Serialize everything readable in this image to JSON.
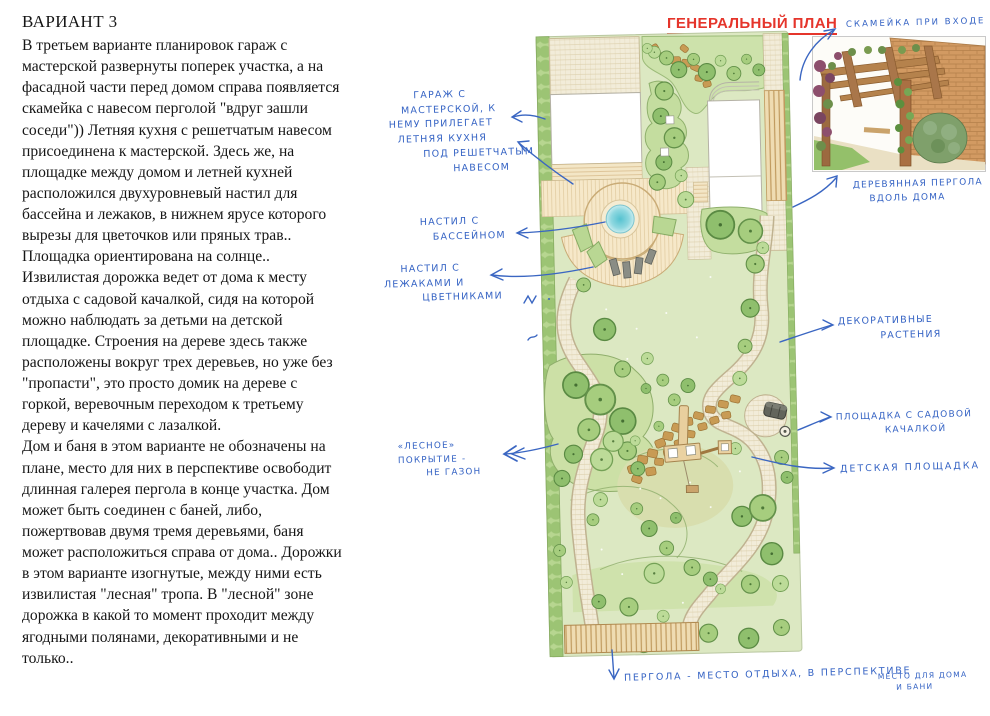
{
  "variant": {
    "title": "ВАРИАНТ 3",
    "paragraphs": [
      "В третьем варианте планировок гараж с мастерской развернуты поперек участка, а на фасадной части перед домом справа появляется скамейка с навесом перголой \"вдруг зашли соседи\")) Летняя кухня с решетчатым навесом присоединена к мастерской. Здесь же, на площадке между домом и летней кухней расположился двухуровневый настил для бассейна и лежаков, в нижнем ярусе которого вырезы для цветочков или пряных трав.. Площадка ориентирована на солнце..",
      "Извилистая дорожка ведет от дома к месту отдыха с садовой качалкой, сидя на которой можно наблюдать за детьми на детской площадке. Строения на дереве здесь также расположены вокруг трех деревьев, но уже без \"пропасти\", это просто домик на дереве с горкой, веревочным переходом к третьему дереву и качелями с лазалкой.",
      "Дом и баня в этом варианте не обозначены на плане, место для них в перспективе освободит длинная галерея пергола в конце участка. Дом может быть соединен с баней, либо, пожертвовав двумя тремя деревьями, баня может расположиться справа от дома.. Дорожки в этом варианте изогнутые, между ними есть извилистая \"лесная\" тропа. В \"лесной\" зоне дорожка в какой то момент проходит между ягодными полянами, декоративными и не только.."
    ]
  },
  "plan": {
    "title": "ГЕНЕРАЛЬНЫЙ ПЛАН"
  },
  "annotations": {
    "bench": "СКАМЕЙКА ПРИ ВХОДЕ",
    "garage": "      ГАРАЖ С\n   МАСТЕРСКОЙ, К\nНЕМУ ПРИЛЕГАЕТ\n  ЛЕТНЯЯ КУХНЯ\n        ПОД РЕШЕТЧАТЫМ\n               НАВЕСОМ",
    "pool_deck": "НАСТИЛ С\n   БАССЕЙНОМ",
    "lounger_deck": "    НАСТИЛ С\nЛЕЖАКАМИ И\n         ЦВЕТНИКАМИ",
    "forest_cover": "«ЛЕСНОЕ»\nПОКРЫТИЕ -\n       НЕ ГАЗОН",
    "pergola_house": "ДЕРЕВЯННАЯ ПЕРГОЛА\n    ВДОЛЬ ДОМА",
    "decorative": "ДЕКОРАТИВНЫЕ\n          РАСТЕНИЯ",
    "swing_area": "ПЛОЩАДКА С САДОВОЙ\n            КАЧАЛКОЙ",
    "playground": "ДЕТСКАЯ ПЛОЩАДКА",
    "pergola_bottom": "ПЕРГОЛА - МЕСТО ОТДЫХА, В ПЕРСПЕКТИВЕ",
    "pergola_bottom_small": "МЕСТО ДЛЯ ДОМА\n     И БАНИ"
  },
  "colors": {
    "accent_red": "#e5352b",
    "ink_blue": "#3563c4"
  }
}
